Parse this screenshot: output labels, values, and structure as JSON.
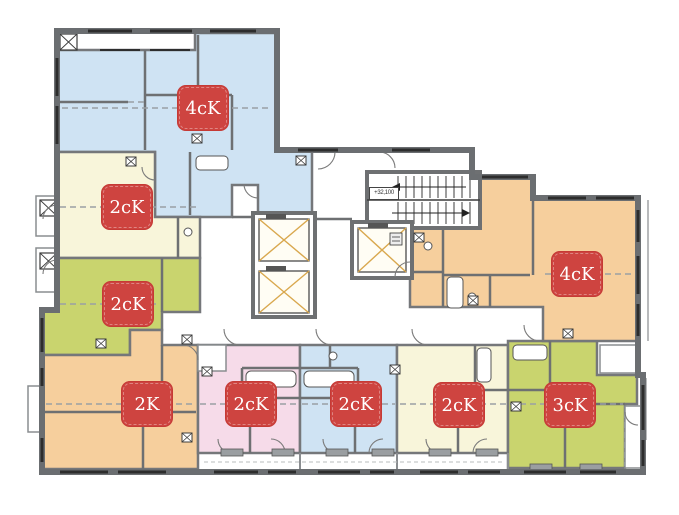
{
  "plan": {
    "elevation_label": "+32,100",
    "colors": {
      "wall": "#6e7072",
      "label_background": "#ce4440",
      "label_text": "#ffffff",
      "blue": "#cfe3f3",
      "cream": "#f8f5da",
      "green": "#c9d46e",
      "orange": "#f6cf9d",
      "pink": "#f6dbe9"
    },
    "apartments": [
      {
        "id": "apt-4ck-top-left",
        "type_label": "4cK",
        "color": "#cfe3f3"
      },
      {
        "id": "apt-2ck-left-upper",
        "type_label": "2cK",
        "color": "#f8f5da"
      },
      {
        "id": "apt-2ck-left-lower",
        "type_label": "2cK",
        "color": "#c9d46e"
      },
      {
        "id": "apt-2k-bottom-left",
        "type_label": "2K",
        "color": "#f6cf9d"
      },
      {
        "id": "apt-2ck-bottom-pink",
        "type_label": "2cK",
        "color": "#f6dbe9"
      },
      {
        "id": "apt-2ck-bottom-blue",
        "type_label": "2cK",
        "color": "#cfe3f3"
      },
      {
        "id": "apt-2ck-bottom-cream",
        "type_label": "2cK",
        "color": "#f8f5da"
      },
      {
        "id": "apt-3ck-bottom-right",
        "type_label": "3cK",
        "color": "#c9d46e"
      },
      {
        "id": "apt-4ck-right",
        "type_label": "4cK",
        "color": "#f6cf9d"
      }
    ]
  }
}
